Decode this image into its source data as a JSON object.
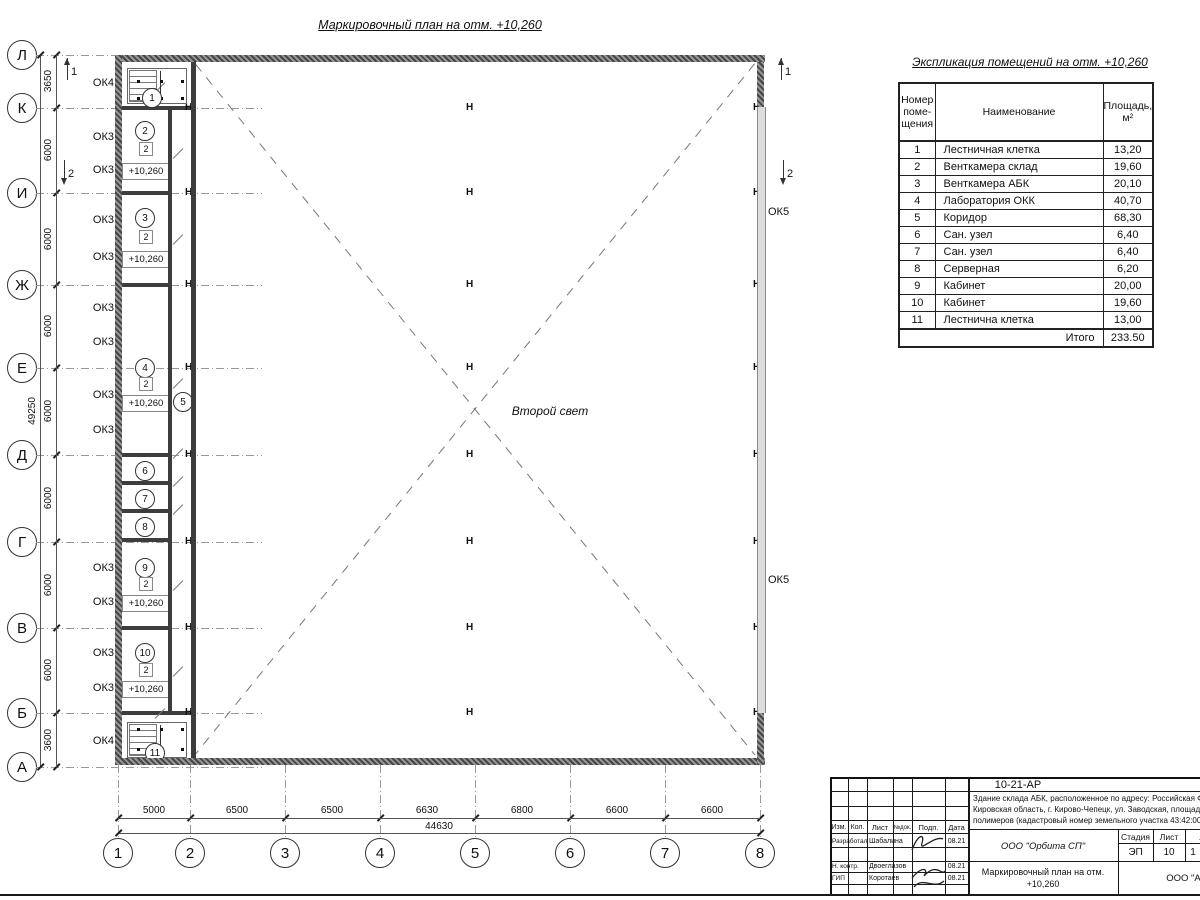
{
  "plan": {
    "title": "Маркировочный план на отм. +10,260",
    "second_light": "Второй свет",
    "axis_rows": [
      "Л",
      "К",
      "И",
      "Ж",
      "Е",
      "Д",
      "Г",
      "В",
      "Б",
      "А"
    ],
    "axis_cols": [
      "1",
      "2",
      "3",
      "4",
      "5",
      "6",
      "7",
      "8"
    ],
    "v_dims": [
      "3650",
      "6000",
      "6000",
      "6000",
      "6000",
      "6000",
      "6000",
      "6000",
      "3600"
    ],
    "v_total": "49250",
    "h_dims": [
      "5000",
      "6500",
      "6500",
      "6630",
      "6800",
      "6600",
      "6600"
    ],
    "h_total": "44630",
    "left_windows": [
      "ОК4",
      "ОК3",
      "ОК3",
      "ОК3",
      "ОК3",
      "ОК3",
      "ОК3",
      "ОК3",
      "ОК3",
      "ОК3",
      "ОК3",
      "ОК3",
      "ОК3",
      "ОК4"
    ],
    "right_windows": [
      "ОК5",
      "ОК5"
    ],
    "level_mark": "+10,260",
    "door_mark": "2",
    "sections": [
      "1",
      "2"
    ],
    "column_symbol": "Н",
    "rooms": [
      "1",
      "2",
      "3",
      "4",
      "5",
      "6",
      "7",
      "8",
      "9",
      "10",
      "11"
    ]
  },
  "expl_table": {
    "title": "Экспликация помещений на отм. +10,260",
    "col_headers": [
      "Номер\nпоме-\nщения",
      "Наименование",
      "Площадь,\nм²"
    ],
    "rows": [
      {
        "n": "1",
        "name": "Лестничная клетка",
        "area": "13,20"
      },
      {
        "n": "2",
        "name": "Венткамера склад",
        "area": "19,60"
      },
      {
        "n": "3",
        "name": "Венткамера АБК",
        "area": "20,10"
      },
      {
        "n": "4",
        "name": "Лаборатория ОКК",
        "area": "40,70"
      },
      {
        "n": "5",
        "name": "Коридор",
        "area": "68,30"
      },
      {
        "n": "6",
        "name": "Сан. узел",
        "area": "6,40"
      },
      {
        "n": "7",
        "name": "Сан. узел",
        "area": "6,40"
      },
      {
        "n": "8",
        "name": "Серверная",
        "area": "6,20"
      },
      {
        "n": "9",
        "name": "Кабинет",
        "area": "20,00"
      },
      {
        "n": "10",
        "name": "Кабинет",
        "area": "19,60"
      },
      {
        "n": "11",
        "name": "Лестнична клетка",
        "area": "13,00"
      }
    ],
    "total_label": "Итого",
    "total_value": "233.50"
  },
  "title_block": {
    "code": "10-21-АР",
    "description": "Здание склада АБК, расположенное по адресу: Российская Феде\nКировская область, г. Кирово-Чепецк, ул. Заводская, площадка з\nполимеров (кадастровый номер земельного участка 43:42:0000",
    "col_labels": [
      "Изм.",
      "Кол.",
      "Лист",
      "№док.",
      "Подп.",
      "Дата"
    ],
    "signature_rows": [
      {
        "role": "Разработал",
        "name": "Шабалина",
        "date": "08.21"
      },
      {
        "role": "Н. контр.",
        "name": "Двоеглазов",
        "date": "08.21"
      },
      {
        "role": "ГИП",
        "name": "Коротаев",
        "date": "08.21"
      }
    ],
    "org1": "ООО \"Орбита СП\"",
    "stage_labels": [
      "Стадия",
      "Лист",
      "Листов"
    ],
    "stage_values": [
      "ЭП",
      "10",
      "1"
    ],
    "doc_title": "Маркировочный план на отм.\n+10,260",
    "org2": "ООО \"Альянс\""
  }
}
